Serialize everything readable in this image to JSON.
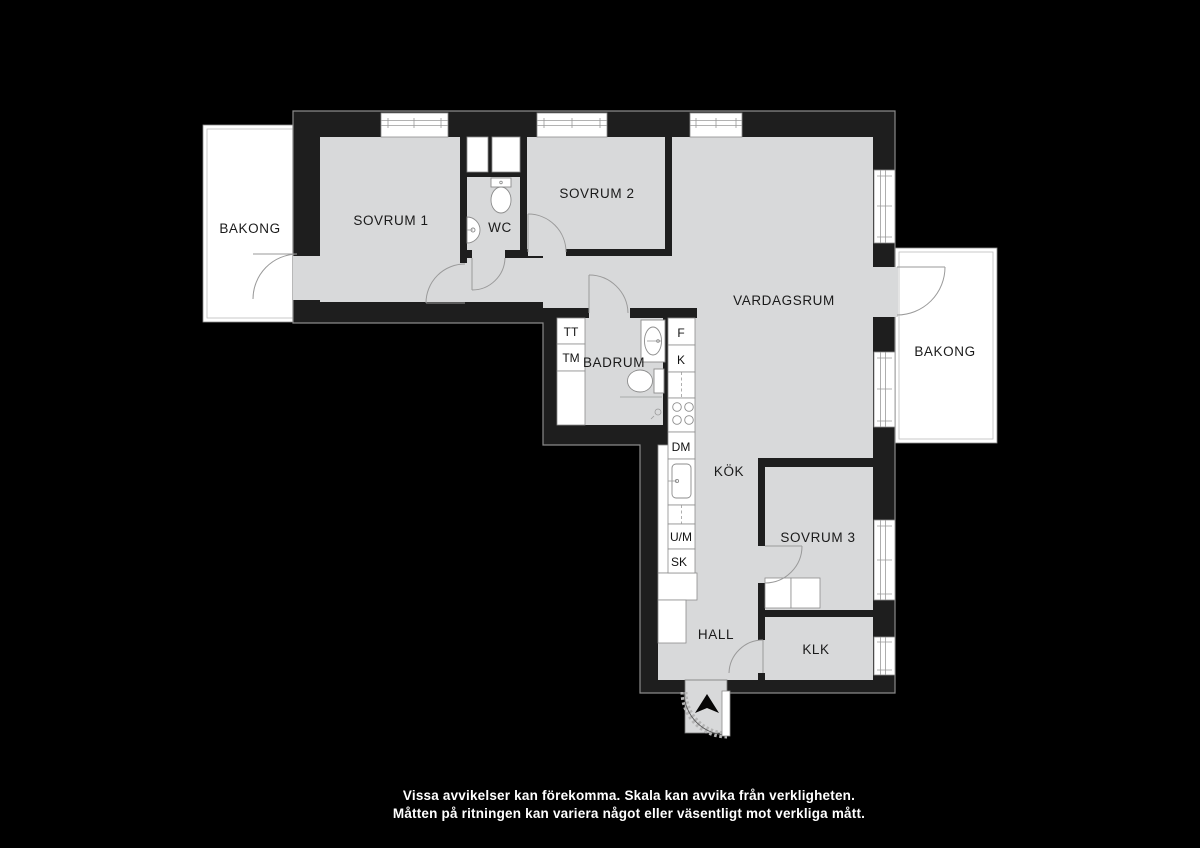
{
  "canvas": {
    "width": 1200,
    "height": 848,
    "background": "#000000"
  },
  "colors": {
    "wall": "#1e1e1e",
    "floor": "#d8d9da",
    "fixture_white": "#ffffff",
    "line": "#9a9a9a",
    "label_text": "#1a1a1a",
    "disclaimer_text": "#ffffff"
  },
  "floorplan": {
    "labels": {
      "bakong_left": "BAKONG",
      "sovrum1": "SOVRUM 1",
      "wc": "WC",
      "sovrum2": "SOVRUM 2",
      "vardagsrum": "VARDAGSRUM",
      "bakong_right": "BAKONG",
      "tt": "TT",
      "tm": "TM",
      "badrum": "BADRUM",
      "f": "F",
      "k": "K",
      "dm": "DM",
      "kok": "KÖK",
      "um": "U/M",
      "sk": "SK",
      "sovrum3": "SOVRUM 3",
      "hall": "HALL",
      "klk": "KLK"
    },
    "disclaimer": {
      "line1": "Vissa avvikelser kan förekomma. Skala kan avvika från verkligheten.",
      "line2": "Måtten på ritningen kan variera något eller väsentligt mot verkliga mått."
    }
  }
}
